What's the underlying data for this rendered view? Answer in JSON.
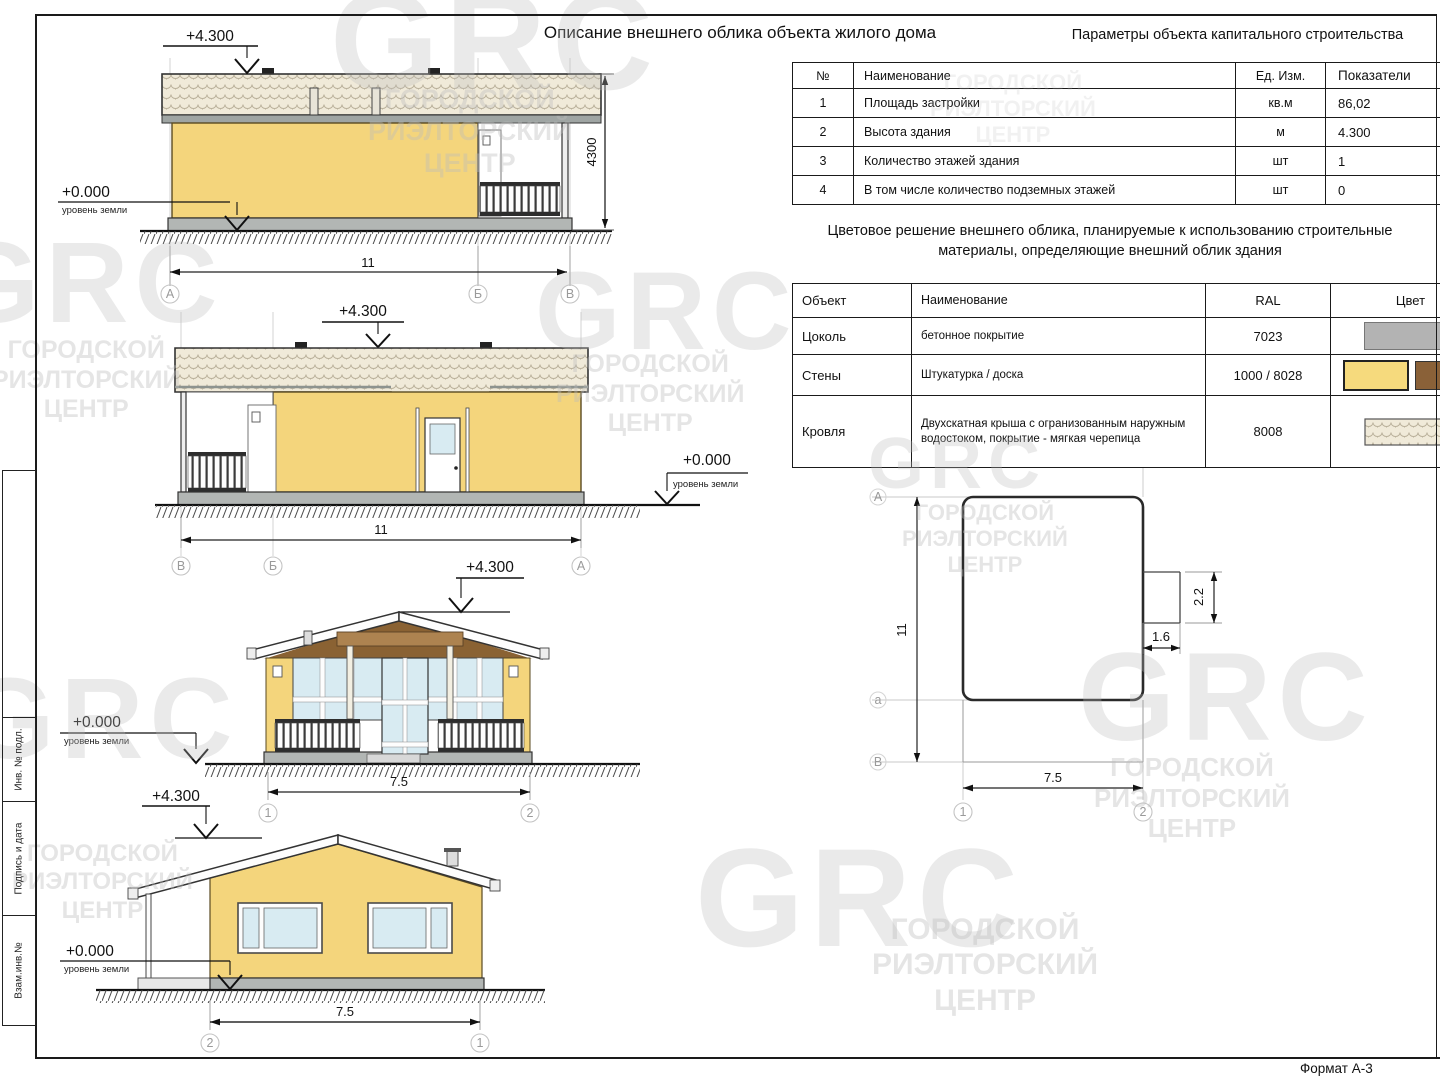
{
  "sheet": {
    "format_label": "Формат А-3"
  },
  "stamp": {
    "cells": [
      {
        "label": "Инв. № подл."
      },
      {
        "label": "Подпись и дата"
      },
      {
        "label": "Взам.инв.№"
      }
    ]
  },
  "watermark": {
    "logo": "GRC",
    "line1": "ГОРОДСКОЙ",
    "line2": "РИЭЛТОРСКИЙ",
    "line3": "ЦЕНТР"
  },
  "titles": {
    "main": "Описание внешнего облика объекта жилого дома",
    "params": "Параметры объекта капитального строительства",
    "colors_line1": "Цветовое решение внешнего облика, планируемые к использованию строительные",
    "colors_line2": "материалы, определяющие внешний облик здания",
    "config": "Конфигурация объекта строительства жилого дома"
  },
  "params_table": {
    "headers": {
      "num": "№",
      "name": "Наименование",
      "unit": "Ед. Изм.",
      "value": "Показатели"
    },
    "rows": [
      {
        "num": "1",
        "name": "Площадь застройки",
        "unit": "кв.м",
        "value": "86,02"
      },
      {
        "num": "2",
        "name": "Высота здания",
        "unit": "м",
        "value": "4.300"
      },
      {
        "num": "3",
        "name": "Количество этажей здания",
        "unit": "шт",
        "value": "1"
      },
      {
        "num": "4",
        "name": "В том числе количество подземных этажей",
        "unit": "шт",
        "value": "0"
      }
    ]
  },
  "colors_table": {
    "headers": {
      "object": "Объект",
      "name": "Наименование",
      "ral": "RAL",
      "color": "Цвет"
    },
    "rows": [
      {
        "object": "Цоколь",
        "name": "бетонное покрытие",
        "ral": "7023",
        "swatches": [
          "#b3b3b3"
        ]
      },
      {
        "object": "Стены",
        "name": "Штукатурка / доска",
        "ral": "1000 / 8028",
        "swatches": [
          "#f6da7d",
          "#8a6138"
        ]
      },
      {
        "object": "Кровля",
        "name": "Двухскатная крыша с огранизованным наружным водостоком, покрытие - мягкая черепица",
        "ral": "8008",
        "swatches": [],
        "swatch_type": "shingle-pattern"
      }
    ]
  },
  "levels": {
    "top": "+4.300",
    "zero": "+0.000",
    "ground_label": "уровень земли"
  },
  "dims": {
    "building_height_mm": "4300",
    "length_m": "11",
    "width_m": "7.5",
    "porch_depth_m": "1.6",
    "porch_width_m": "2.2"
  },
  "axes": {
    "a": "А",
    "b": "Б",
    "v": "В",
    "a_small": "а",
    "n1": "1",
    "n2": "2"
  },
  "palette": {
    "wall_yellow": "#f4d57c",
    "gable_brown": "#8a6233",
    "soffit_brown": "#ad8350",
    "plinth_gray": "#b2b6b4",
    "glass_blue": "#d8ebf2",
    "roof_bg": "#f0ead9",
    "swatch_gray": "#b3b3b3",
    "swatch_yellow": "#f6da7d",
    "swatch_brown": "#8a6138"
  }
}
